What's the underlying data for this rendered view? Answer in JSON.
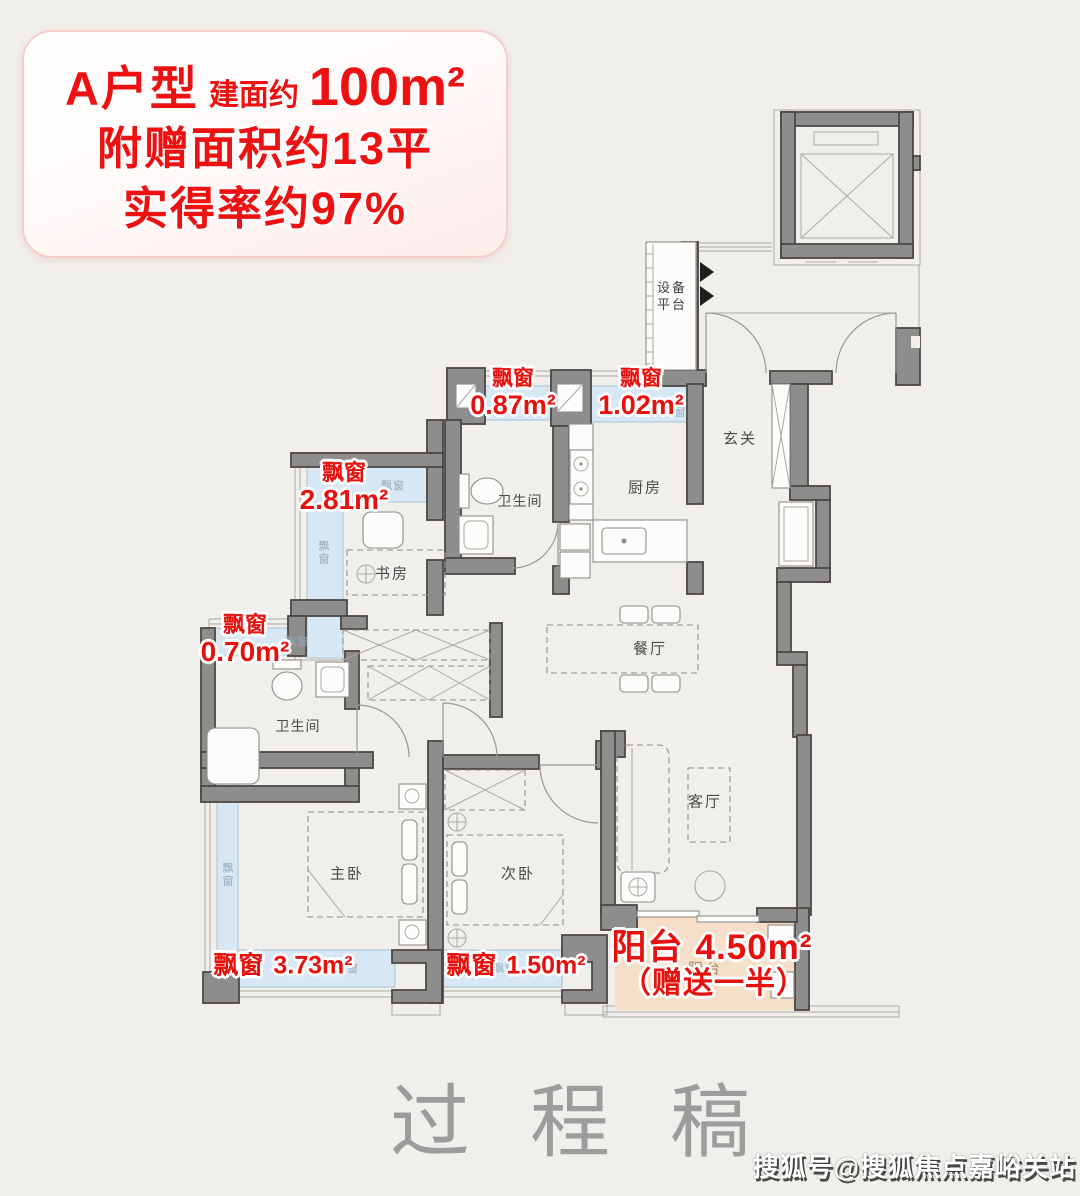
{
  "header": {
    "title": "A户型",
    "area_prefix": "建面约",
    "area_value": "100m²",
    "bonus_line": "附赠面积约13平",
    "rate_line": "实得率约97%"
  },
  "rooms": {
    "equipment_platform": {
      "line1": "设备",
      "line2": "平台"
    },
    "hallway": "玄关",
    "kitchen": "厨房",
    "bathroom_top": "卫生间",
    "study": "书房",
    "dining": "餐厅",
    "bathroom_mid": "卫生间",
    "living": "客厅",
    "master_bedroom": "主卧",
    "second_bedroom": "次卧"
  },
  "bay_windows": {
    "small_tag": "飘窗",
    "top_left": {
      "name": "飘窗",
      "area": "0.87m²"
    },
    "top_right": {
      "name": "飘窗",
      "area": "1.02m²"
    },
    "study": {
      "name": "飘窗",
      "area": "2.81m²"
    },
    "mid_left": {
      "name": "飘窗",
      "area": "0.70m²"
    },
    "master": {
      "name": "飘窗",
      "area": "3.73m²"
    },
    "second": {
      "name": "飘窗",
      "area": "1.50m²"
    }
  },
  "balcony": {
    "name": "阳台",
    "area": "4.50m²",
    "note": "（赠送一半）",
    "faint_tag": "阳台"
  },
  "watermarks": {
    "draft": "过程稿",
    "sohu": "搜狐号@搜狐焦点嘉峪关站"
  },
  "colors": {
    "page_bg": "#f1efec",
    "wall": "#8d8d8d",
    "wall_outline": "#4e4744",
    "bay_window": "#d7e8f4",
    "balcony": "#f5dfc8",
    "label_red": "#e8100c",
    "header_red": "#ee1111",
    "room_text": "#4a4a4a",
    "watermark_gray": "#9c9c9c"
  }
}
